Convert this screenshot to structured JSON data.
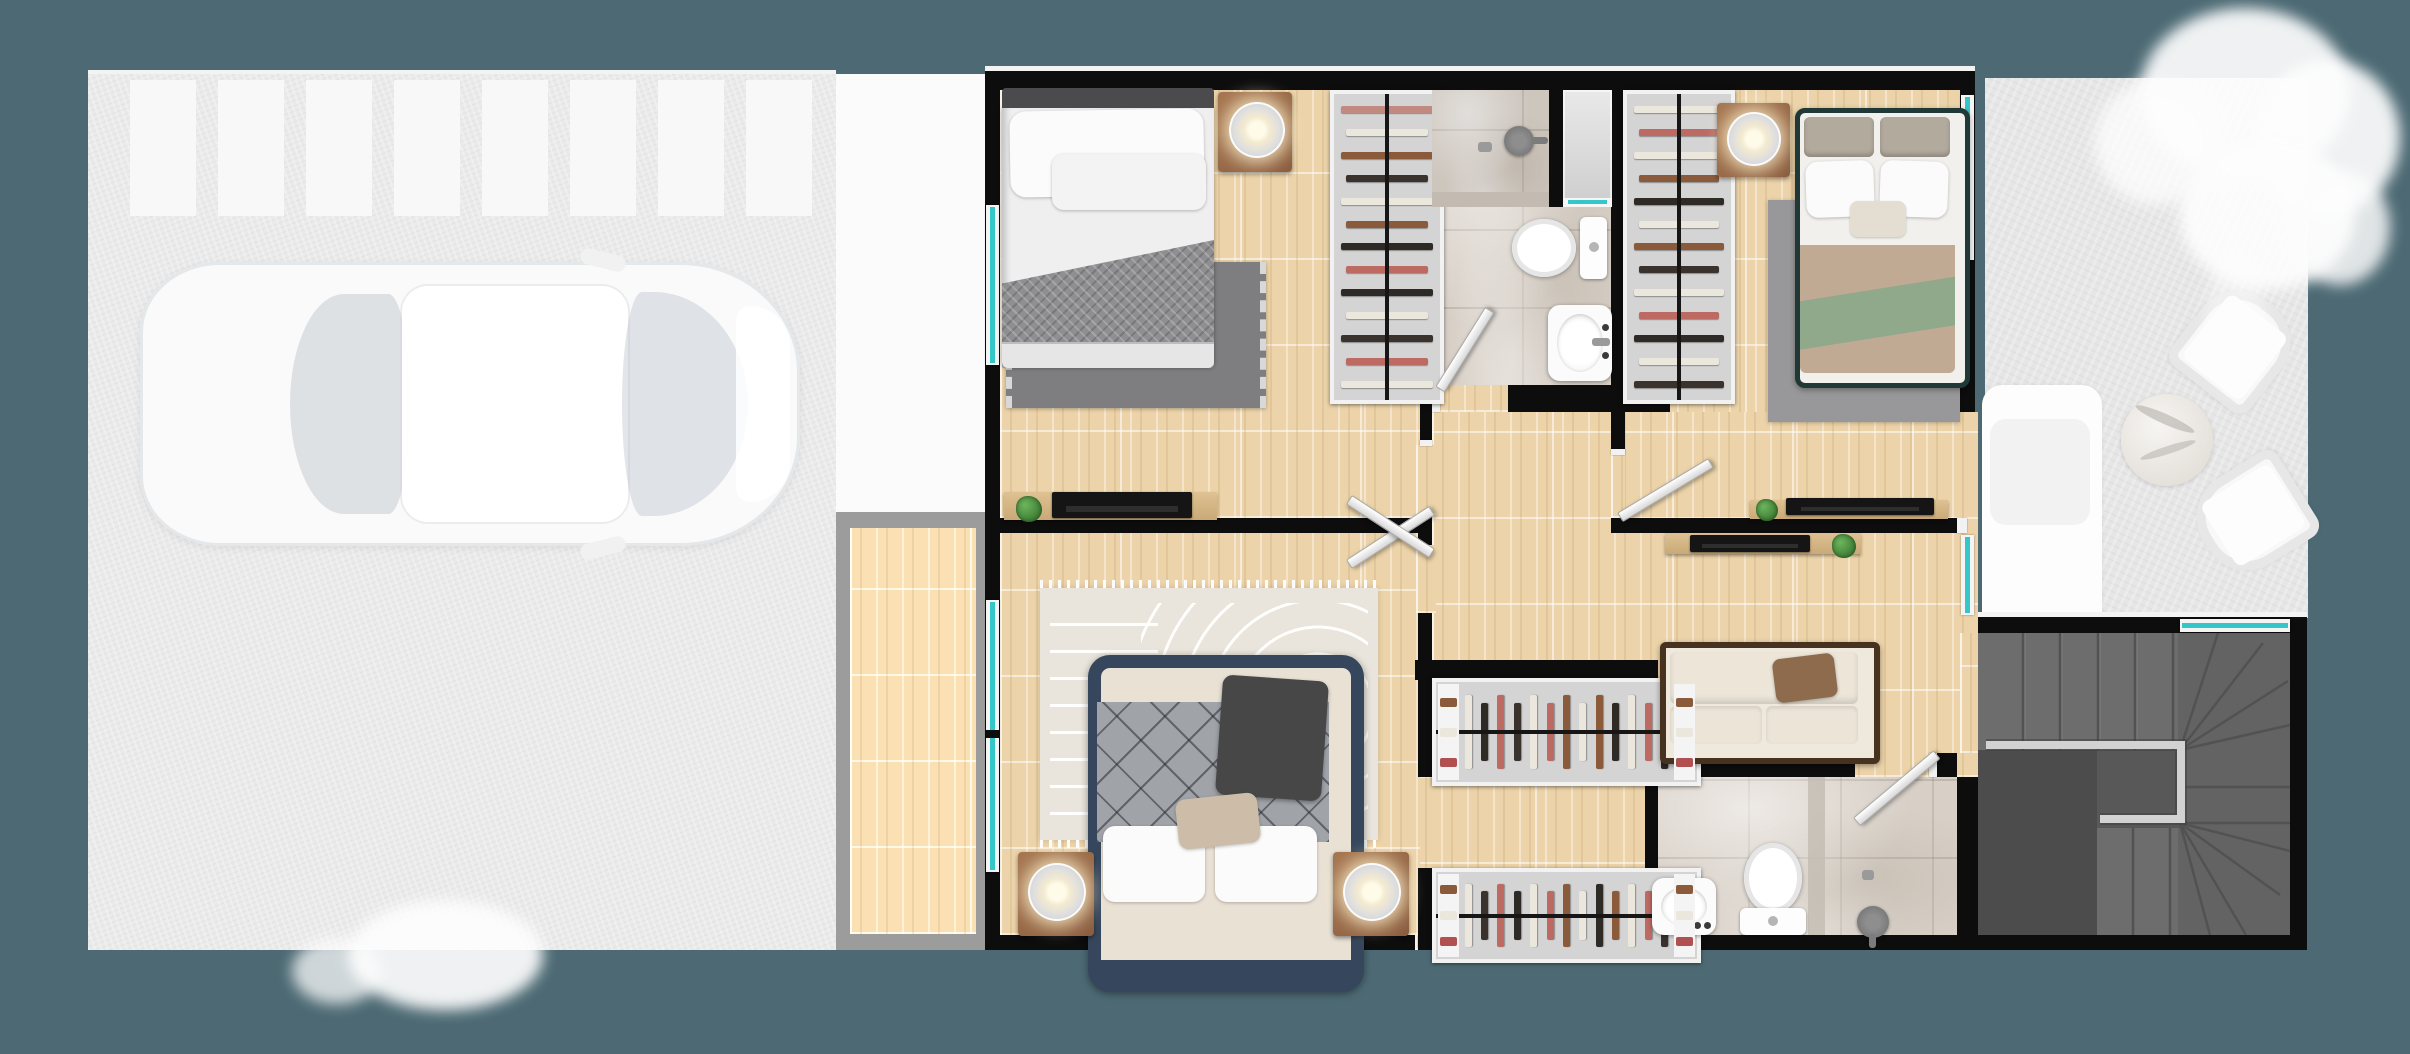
{
  "scene": {
    "type": "architectural-floor-plan-render",
    "view": "top-down",
    "rooms": [
      "garage",
      "porch",
      "balcony",
      "bedroom-left",
      "bathroom-top",
      "bedroom-right",
      "hallway",
      "walk-in-closet",
      "master-bedroom",
      "bathroom-bottom",
      "staircase",
      "patio"
    ]
  },
  "palette": {
    "background": "#4d6a74",
    "wall": "#0d0d0e",
    "wood_floor": "#ecd3a9",
    "marble_floor": "#d8d0c7",
    "marble_dark": "#c3bbb1",
    "glass_window": "#35c6c8",
    "window_frame": "#f4f4f4",
    "garage_concrete": "#eaeaea",
    "parking_stripe": "#f8f8f8",
    "porch_white": "#fbfbfb",
    "balcony_frame": "#9c9c9c",
    "grass": "#e6e6e6",
    "tree_foliage": "#fdfdfd",
    "stair_tread": "#6d6d6d",
    "stair_landing": "#4c4c4c",
    "stair_rail": "#d2d2d2",
    "nightstand_wood": "#9b6d4d",
    "bed1_headboard": "#4b4b4d",
    "bed1_blanket": "#8f8f91",
    "bed2_frame": "#203836",
    "bed2_blanket_tan": "#c1aa94",
    "bed2_blanket_green": "#90a98a",
    "master_bed_frame": "#36475d",
    "master_blanket_gray": "#a0a4a9",
    "master_blanket_navy": "#2c3d52",
    "sofa_frame": "#46321f",
    "sofa_cream": "#ece5d8",
    "sofa_pillow_brown": "#8d6b4c",
    "plant_green": "#55a047",
    "rug_dark": "#7e7e80",
    "rug_gray": "#98989a",
    "rug_master": "#e9e5dc"
  },
  "garage": {
    "parking_stripe_count": 8,
    "cars": 1
  },
  "closets": {
    "vertical_left_items": [
      "#c08a80",
      "#ece7dc",
      "#8a5a3a",
      "#3a322c",
      "#ece7dc",
      "#8a5a3a",
      "#2e2a26",
      "#bc6a62",
      "#2e2a26",
      "#ece7dc",
      "#3a322c",
      "#bc6a62",
      "#ece7dc"
    ],
    "vertical_right_items": [
      "#ece7dc",
      "#bc6a62",
      "#ece7dc",
      "#8a5a3a",
      "#2e2a26",
      "#ece7dc",
      "#8a5a3a",
      "#3a322c",
      "#ece7dc",
      "#bc6a62",
      "#2e2a26",
      "#ece7dc",
      "#3a322c"
    ],
    "horizontal_top_items": [
      "#ece7dc",
      "#2e2a26",
      "#bc6a62",
      "#3a322c",
      "#ece7dc",
      "#bc6a62",
      "#8a5a3a",
      "#ece7dc",
      "#8a5a3a",
      "#2e2a26",
      "#ece7dc",
      "#bc6a62",
      "#2e2a26"
    ],
    "horizontal_bottom_items": [
      "#ece7dc",
      "#3a322c",
      "#bc6a62",
      "#2e2a26",
      "#ece7dc",
      "#bc6a62",
      "#8a5a3a",
      "#ece7dc",
      "#2e2a26",
      "#8a5a3a",
      "#ece7dc",
      "#bc6a62",
      "#3a322c"
    ],
    "shelf_items": [
      "#8a5a3a",
      "#ece7dc",
      "#b05050"
    ]
  },
  "fixtures": {
    "toilets": 2,
    "sinks": 2,
    "showers": 2,
    "beds": 3,
    "lamps": 4,
    "desks": 3,
    "sofa_seats": 2
  },
  "stairs": {
    "straight_treads_top": 5,
    "straight_treads_bottom": 3,
    "winder_treads": 8
  }
}
